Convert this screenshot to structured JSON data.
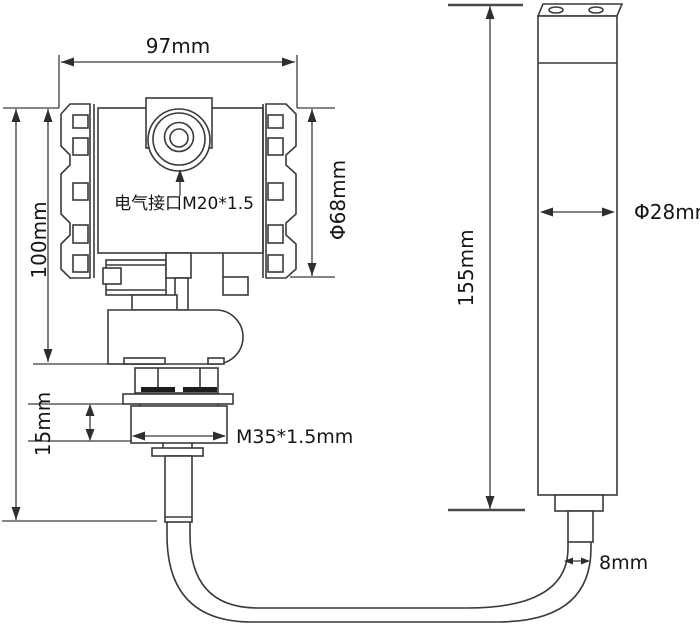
{
  "diagram": {
    "kind": "technical-dimension-drawing",
    "subject": "pressure-level-transmitter-with-probe",
    "colors": {
      "line": "#3a3a3a",
      "text": "#151515",
      "background": "#ffffff"
    }
  },
  "labels": {
    "housing_width": "97mm",
    "housing_height": "100mm",
    "housing_diameter": "Φ68mm",
    "electrical_port": "电气接口M20*1.5",
    "thread_height": "15mm",
    "thread_spec": "M35*1.5mm",
    "probe_length": "155mm",
    "probe_diameter": "Φ28mm",
    "cable_diameter": "8mm"
  }
}
